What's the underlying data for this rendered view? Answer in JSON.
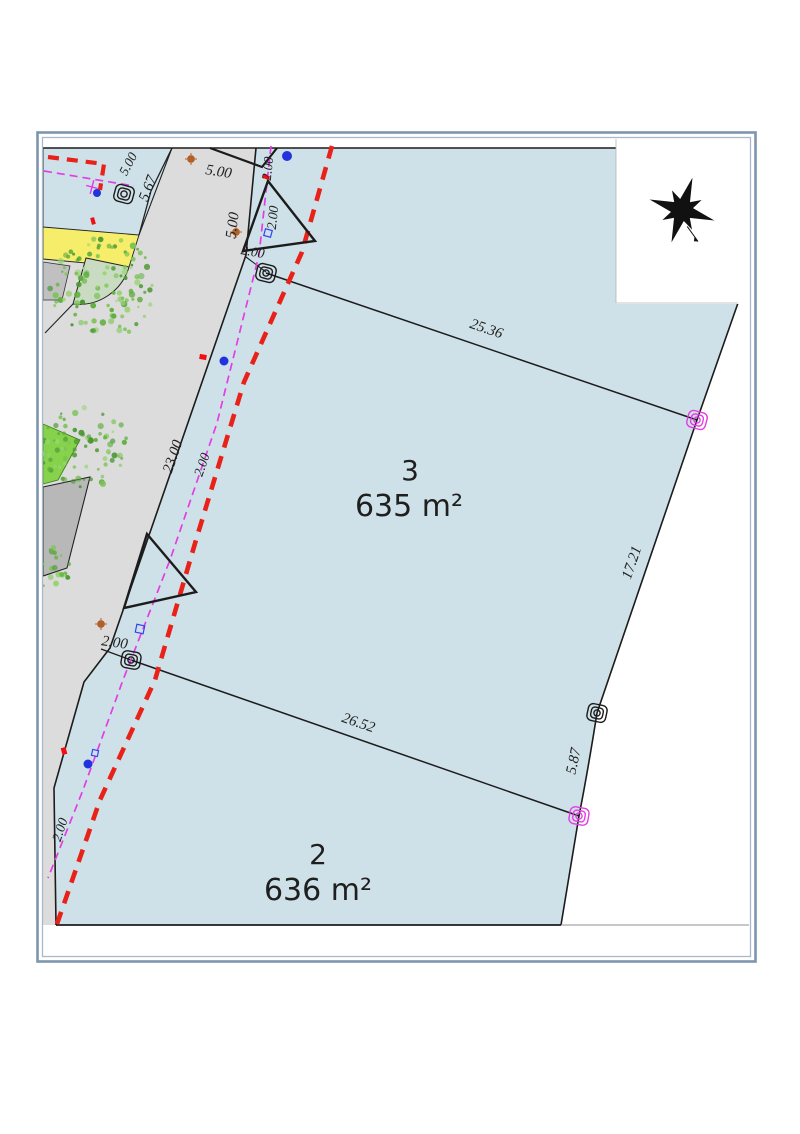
{
  "parcels": {
    "p3": {
      "number": "3",
      "area": "635 m²"
    },
    "p2": {
      "number": "2",
      "area": "636 m²"
    }
  },
  "dimensions": {
    "top_width": "5.00",
    "left_frontage": "5.67",
    "road_edge_width": "5.00",
    "top_offset_vertical": "2.00",
    "top_tick": "2.00",
    "road_frontage": "23.00",
    "mid_tick": "2.00",
    "parcel3_front": "25.36",
    "parcel3_side": "17.21",
    "parcel2_side": "5.87",
    "parcel2_front": "26.52"
  },
  "utility_offsets": {
    "top": "2.00",
    "mid": "2.00",
    "bottom": "2.00",
    "left": "5.00"
  },
  "icons": {
    "compass_rose": "✴",
    "survey_marker": "◉",
    "tree": "❀"
  },
  "colors": {
    "parcel_fill": "#cfe1e8",
    "road_fill": "#dcdcdc",
    "yellow_strip": "#f6ee6b",
    "corner_green": "#c9dcc1",
    "bright_green": "#86d24a",
    "building_gray": "#b8b8b8",
    "boundary": "#1c1c1c",
    "setback_line_red": "#e82218",
    "utility_line_magenta": "#e33ee3",
    "tree_green": "#5fae3c",
    "frame_blue": "#7e95ae",
    "frame_blue_inner": "#a8bac9",
    "marker_blue": "#2233dd",
    "dot_orange": "#b06028",
    "tick_red": "#ee1111"
  }
}
